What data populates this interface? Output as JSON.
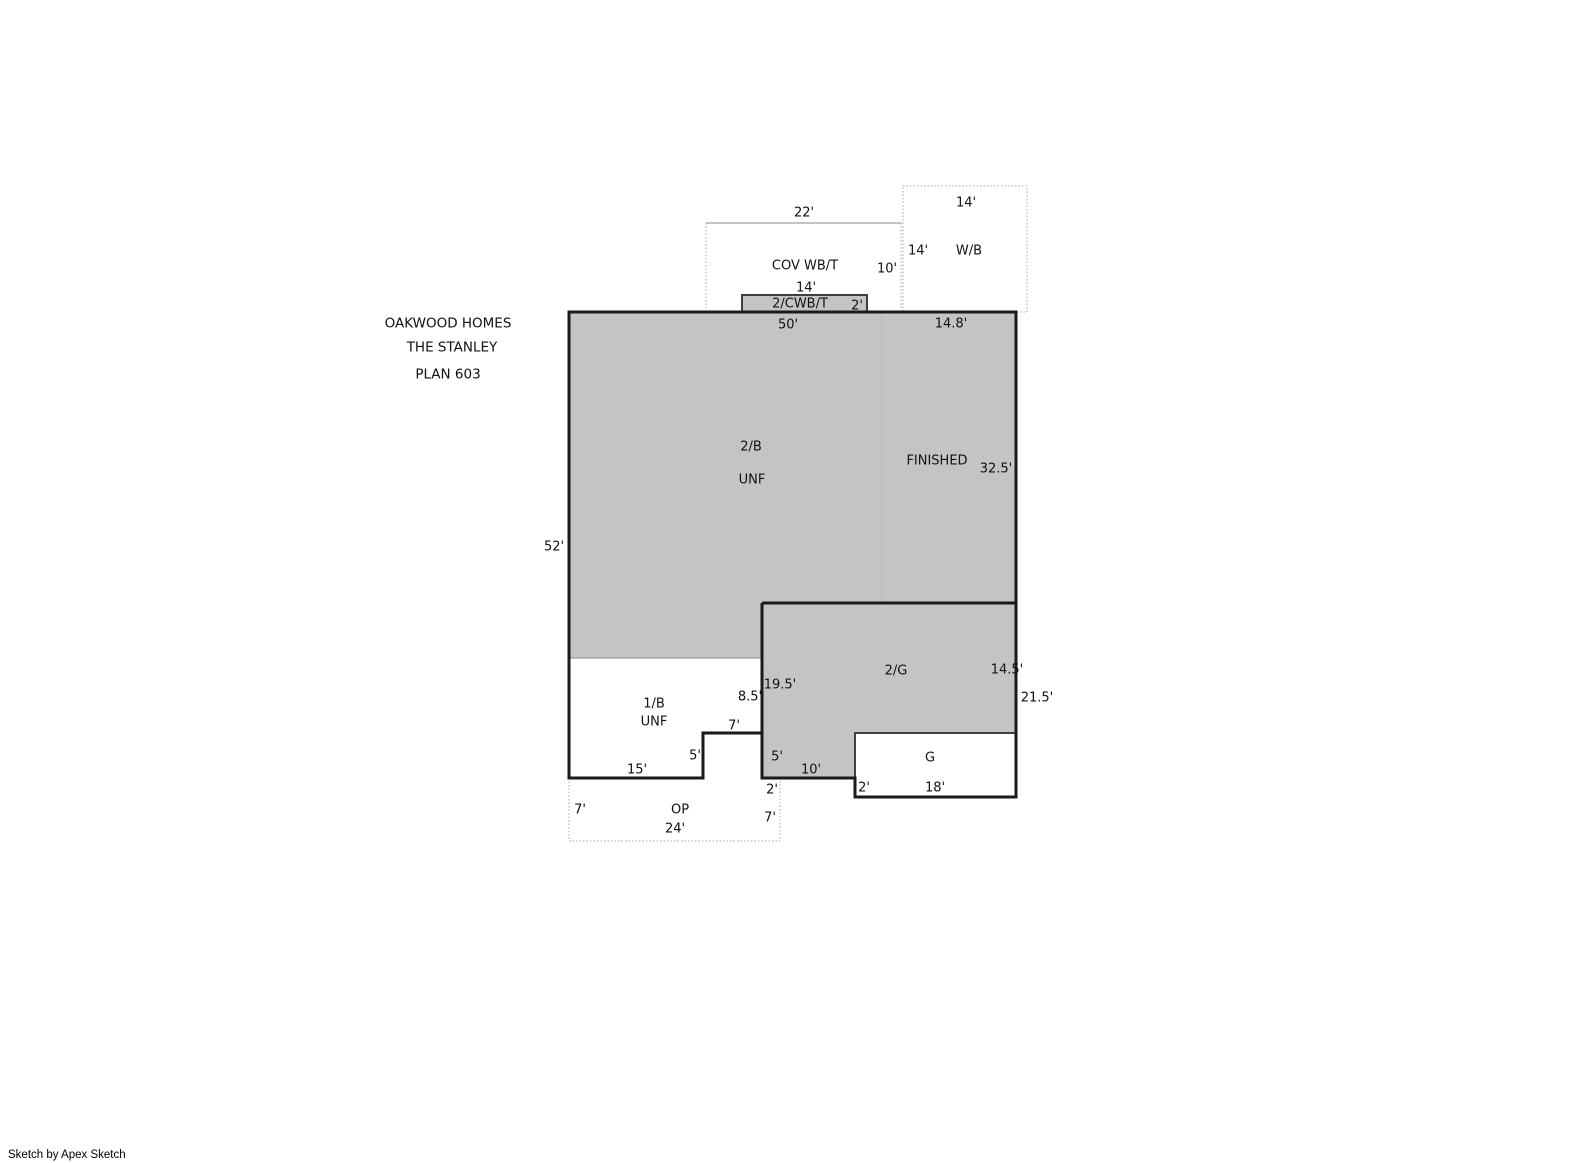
{
  "title_block": {
    "lines": [
      "OAKWOOD HOMES",
      "THE STANLEY",
      "PLAN 603"
    ]
  },
  "credit": "Sketch by Apex Sketch",
  "colors": {
    "background": "#ffffff",
    "area_fill": "#c4c4c4",
    "wall_outline": "#1a1a1a",
    "secondary_outline": "#3f3f3f",
    "interior_line": "#8a8a8a",
    "dotted_line": "#a8a8a8",
    "text": "#111111"
  },
  "floorplan": {
    "areas": [
      {
        "name": "area-2b",
        "label": "2/B",
        "status": "UNF"
      },
      {
        "name": "area-finished",
        "label": "FINISHED",
        "status": ""
      },
      {
        "name": "area-1b",
        "label": "1/B",
        "status": "UNF"
      },
      {
        "name": "area-2g",
        "label": "2/G",
        "status": ""
      },
      {
        "name": "area-g",
        "label": "G",
        "status": ""
      },
      {
        "name": "area-op",
        "label": "OP",
        "status": ""
      },
      {
        "name": "area-cov-wbt",
        "label": "COV WB/T",
        "status": ""
      },
      {
        "name": "area-2cwbt",
        "label": "2/CWB/T",
        "status": ""
      },
      {
        "name": "area-wb",
        "label": "W/B",
        "status": ""
      }
    ],
    "labels": [
      {
        "name": "dim-cov-wbt-width",
        "text": "22'",
        "x": 804,
        "y": 213
      },
      {
        "name": "dim-wb-width",
        "text": "14'",
        "x": 966,
        "y": 203
      },
      {
        "name": "dim-wb-height",
        "text": "14'",
        "x": 918,
        "y": 251
      },
      {
        "name": "label-wb",
        "text": "W/B",
        "x": 969,
        "y": 251
      },
      {
        "name": "dim-cov-wbt-height",
        "text": "10'",
        "x": 887,
        "y": 269
      },
      {
        "name": "label-cov-wbt",
        "text": "COV WB/T",
        "x": 805,
        "y": 266
      },
      {
        "name": "dim-cwbt-width",
        "text": "14'",
        "x": 806,
        "y": 288
      },
      {
        "name": "label-cwbt",
        "text": "2/CWB/T",
        "x": 800,
        "y": 304
      },
      {
        "name": "dim-cwbt-depth",
        "text": "2'",
        "x": 857,
        "y": 306
      },
      {
        "name": "dim-main-top",
        "text": "50'",
        "x": 788,
        "y": 325
      },
      {
        "name": "dim-finished-top",
        "text": "14.8'",
        "x": 951,
        "y": 324
      },
      {
        "name": "dim-left-side",
        "text": "52'",
        "x": 554,
        "y": 547
      },
      {
        "name": "label-2b",
        "text": "2/B",
        "x": 751,
        "y": 447
      },
      {
        "name": "label-2b-unf",
        "text": "UNF",
        "x": 752,
        "y": 480
      },
      {
        "name": "label-finished",
        "text": "FINISHED",
        "x": 937,
        "y": 461
      },
      {
        "name": "dim-finished-right",
        "text": "32.5'",
        "x": 996,
        "y": 469
      },
      {
        "name": "label-2g",
        "text": "2/G",
        "x": 896,
        "y": 671
      },
      {
        "name": "dim-2g-right",
        "text": "14.5'",
        "x": 1007,
        "y": 670
      },
      {
        "name": "dim-right-lower-total",
        "text": "21.5'",
        "x": 1037,
        "y": 698
      },
      {
        "name": "dim-2g-left",
        "text": "19.5'",
        "x": 780,
        "y": 685
      },
      {
        "name": "dim-1b-right",
        "text": "8.5'",
        "x": 750,
        "y": 697
      },
      {
        "name": "label-1b",
        "text": "1/B",
        "x": 654,
        "y": 704
      },
      {
        "name": "label-1b-unf",
        "text": "UNF",
        "x": 654,
        "y": 722
      },
      {
        "name": "dim-1b-step-top",
        "text": "7'",
        "x": 734,
        "y": 726
      },
      {
        "name": "dim-1b-step-right",
        "text": "5'",
        "x": 695,
        "y": 756
      },
      {
        "name": "dim-1b-bottom",
        "text": "15'",
        "x": 637,
        "y": 770
      },
      {
        "name": "dim-2g-left-lower",
        "text": "5'",
        "x": 777,
        "y": 757
      },
      {
        "name": "dim-2g-bottom",
        "text": "10'",
        "x": 811,
        "y": 770
      },
      {
        "name": "dim-op-right-offset",
        "text": "2'",
        "x": 772,
        "y": 790
      },
      {
        "name": "dim-g-left-lower",
        "text": "2'",
        "x": 864,
        "y": 788
      },
      {
        "name": "dim-g-bottom",
        "text": "18'",
        "x": 935,
        "y": 788
      },
      {
        "name": "label-g",
        "text": "G",
        "x": 930,
        "y": 758
      },
      {
        "name": "dim-op-left",
        "text": "7'",
        "x": 580,
        "y": 810
      },
      {
        "name": "label-op",
        "text": "OP",
        "x": 680,
        "y": 810
      },
      {
        "name": "dim-op-bottom",
        "text": "24'",
        "x": 675,
        "y": 829
      },
      {
        "name": "dim-op-right",
        "text": "7'",
        "x": 770,
        "y": 818
      }
    ]
  }
}
